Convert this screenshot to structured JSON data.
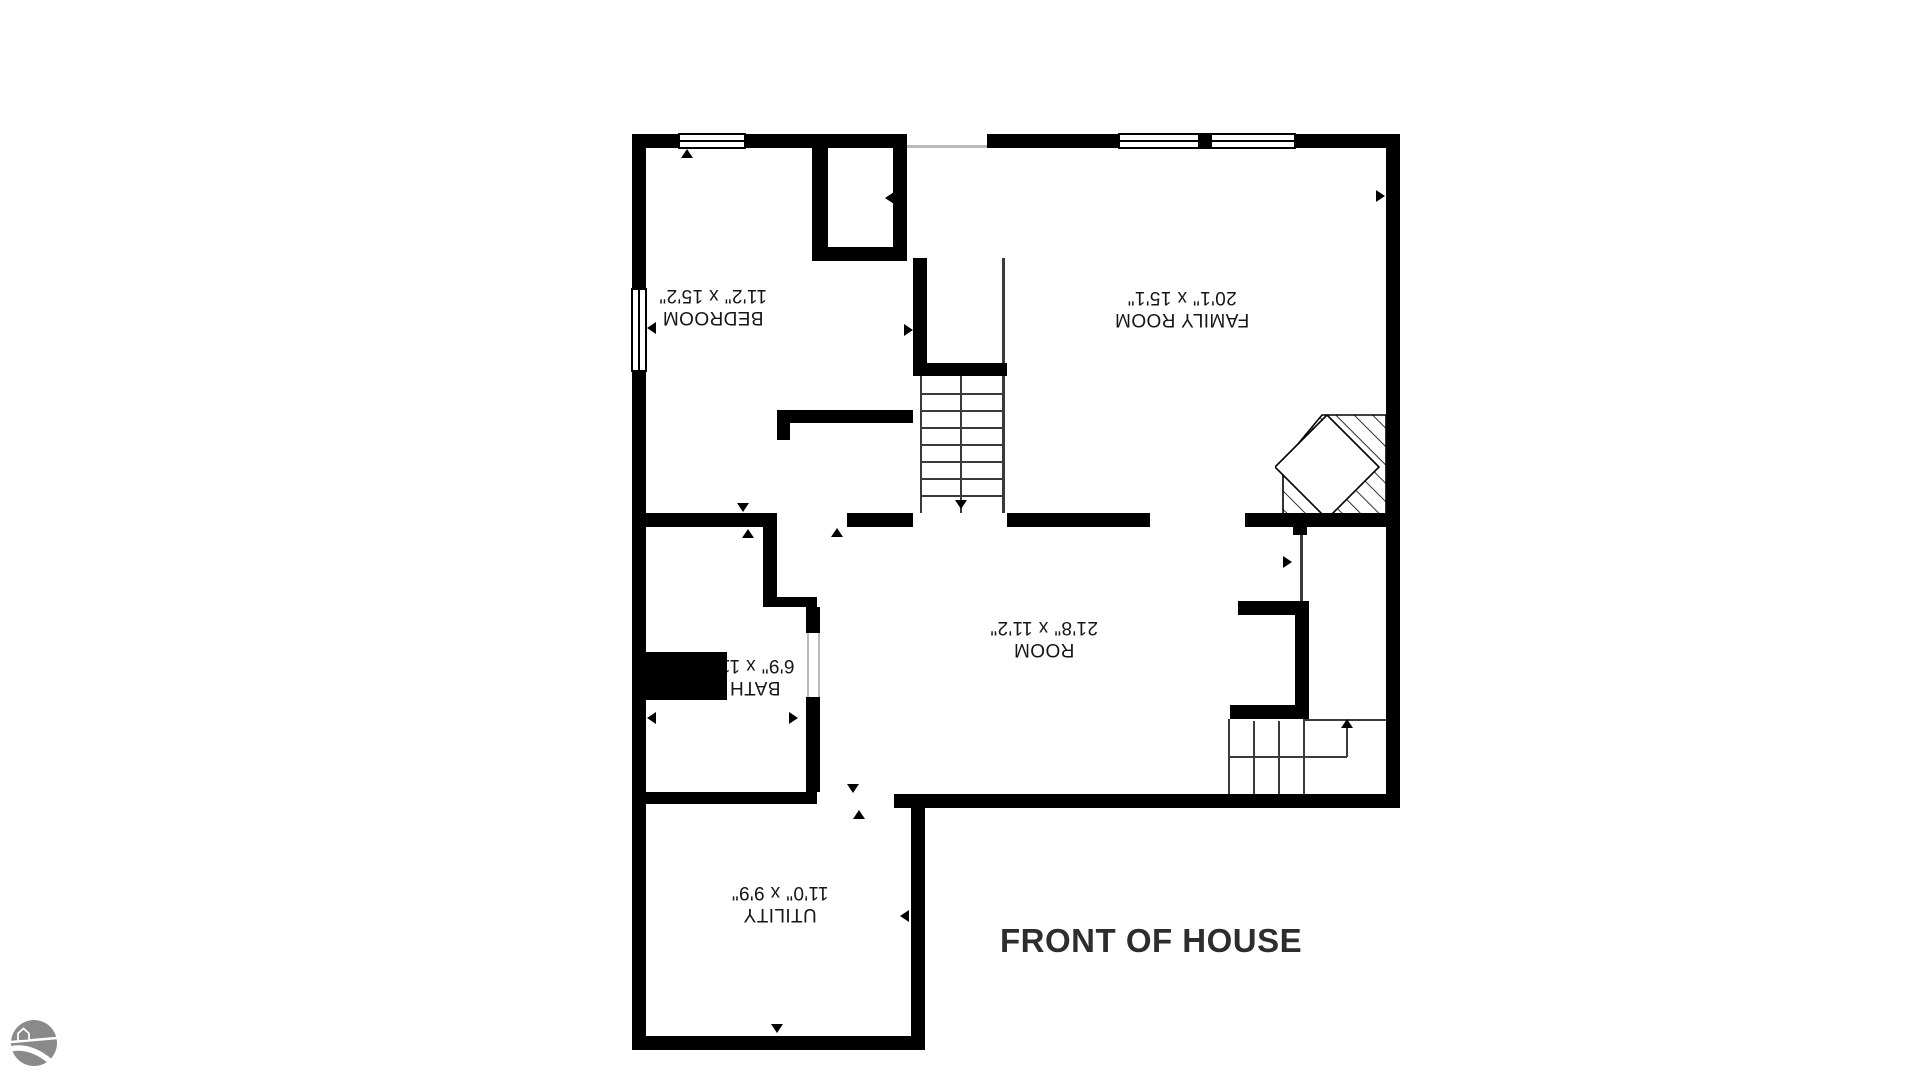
{
  "plan": {
    "rooms": [
      {
        "name": "BEDROOM",
        "dims": "11'2\" x 15'2\""
      },
      {
        "name": "FAMILY ROOM",
        "dims": "20'1\" x 15'1\""
      },
      {
        "name": "ROOM",
        "dims": "21'8\" x 11'2\""
      },
      {
        "name": "BATH",
        "dims": "6'9\" x 11'"
      },
      {
        "name": "UTILITY",
        "dims": "11'0\" x 9'9\""
      }
    ],
    "annotation": "FRONT OF HOUSE",
    "colors": {
      "wall": "#000000",
      "background": "#ffffff",
      "annotation_text": "#2d2d2d",
      "logo_gray": "#8a8a8a"
    },
    "features": [
      "stairs-upper",
      "stairs-lower",
      "fireplace-hatched",
      "windows",
      "door-arrow-markers",
      "brand-logo"
    ]
  }
}
